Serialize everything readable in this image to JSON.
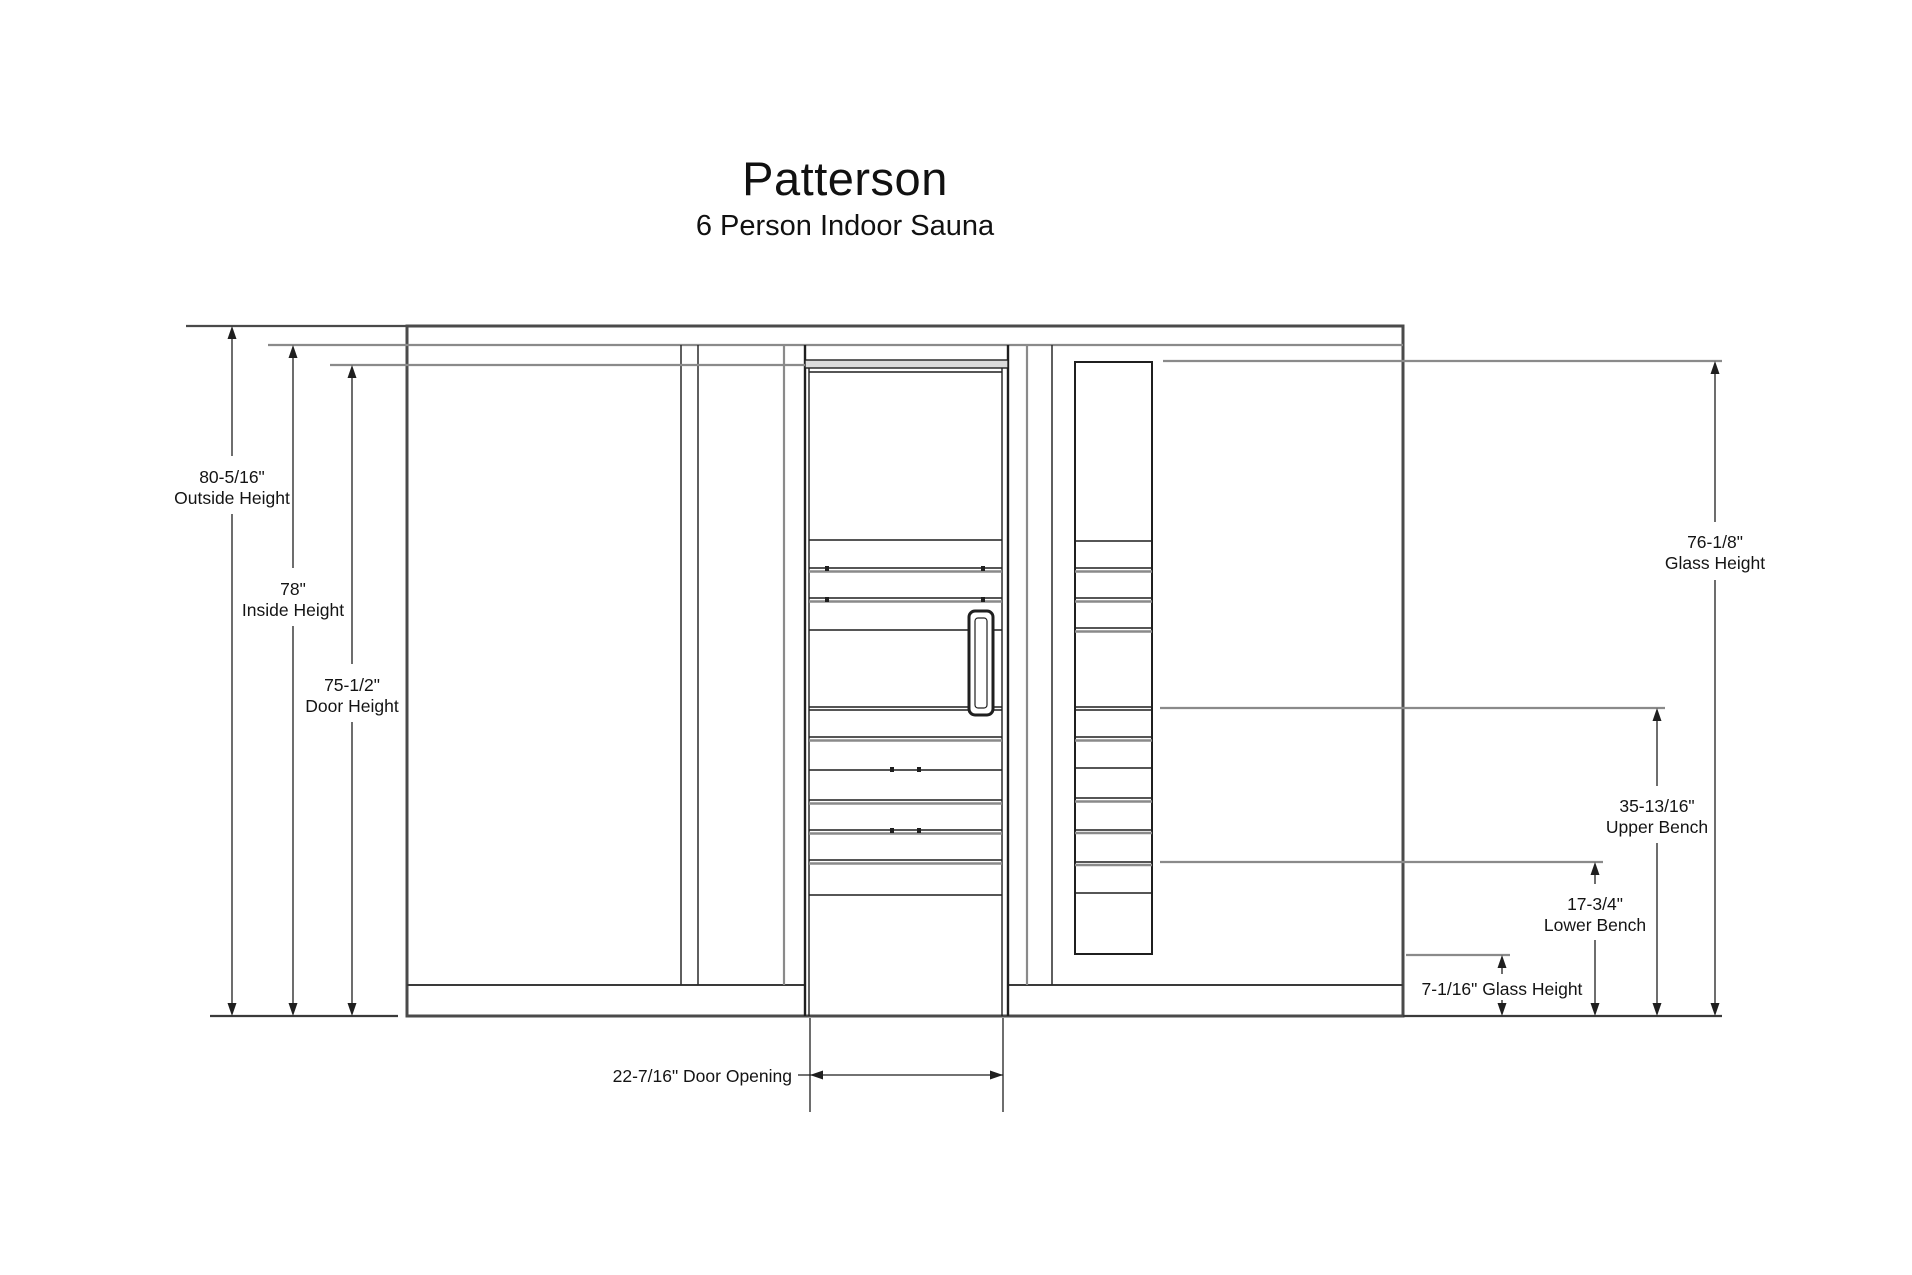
{
  "title": "Patterson",
  "subtitle": "6 Person Indoor Sauna",
  "dimensions": {
    "outside_height": {
      "value": "80-5/16\"",
      "label": "Outside Height"
    },
    "inside_height": {
      "value": "78\"",
      "label": "Inside Height"
    },
    "door_height": {
      "value": "75-1/2\"",
      "label": "Door Height"
    },
    "glass_height": {
      "value": "76-1/8\"",
      "label": "Glass Height"
    },
    "upper_bench": {
      "value": "35-13/16\"",
      "label": "Upper Bench"
    },
    "lower_bench": {
      "value": "17-3/4\"",
      "label": "Lower Bench"
    },
    "glass_height_bottom": {
      "text": "7-1/16\" Glass Height"
    },
    "door_opening": {
      "text": "22-7/16\" Door Opening"
    }
  },
  "colors": {
    "line_dark": "#1f1f1f",
    "line_outline": "#4a4a4a",
    "line_gray": "#8a8a8a",
    "background": "#ffffff"
  }
}
